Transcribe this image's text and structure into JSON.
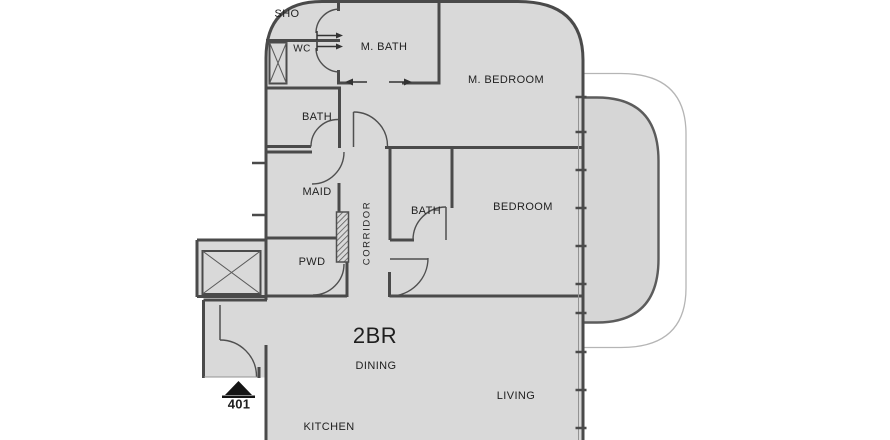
{
  "plan": {
    "unit_type": "2BR",
    "unit_number": "401",
    "rooms": {
      "sho": "SHO",
      "wc": "WC",
      "m_bath": "M. BATH",
      "m_bedroom": "M. BEDROOM",
      "bath_upper": "BATH",
      "maid": "MAID",
      "corridor": "CORRIDOR",
      "bath_inner": "BATH",
      "bedroom": "BEDROOM",
      "pwd": "PWD",
      "dining": "DINING",
      "living": "LIVING",
      "kitchen": "KITCHEN"
    },
    "colors": {
      "floor_fill": "#d9d9d9",
      "wall": "#4a4a4a",
      "balcony_fill": "#d6d6d6",
      "thin_line": "#939393",
      "outer_line": "#b5b5b5",
      "text": "#1f1f1f",
      "background": "#ffffff"
    }
  }
}
